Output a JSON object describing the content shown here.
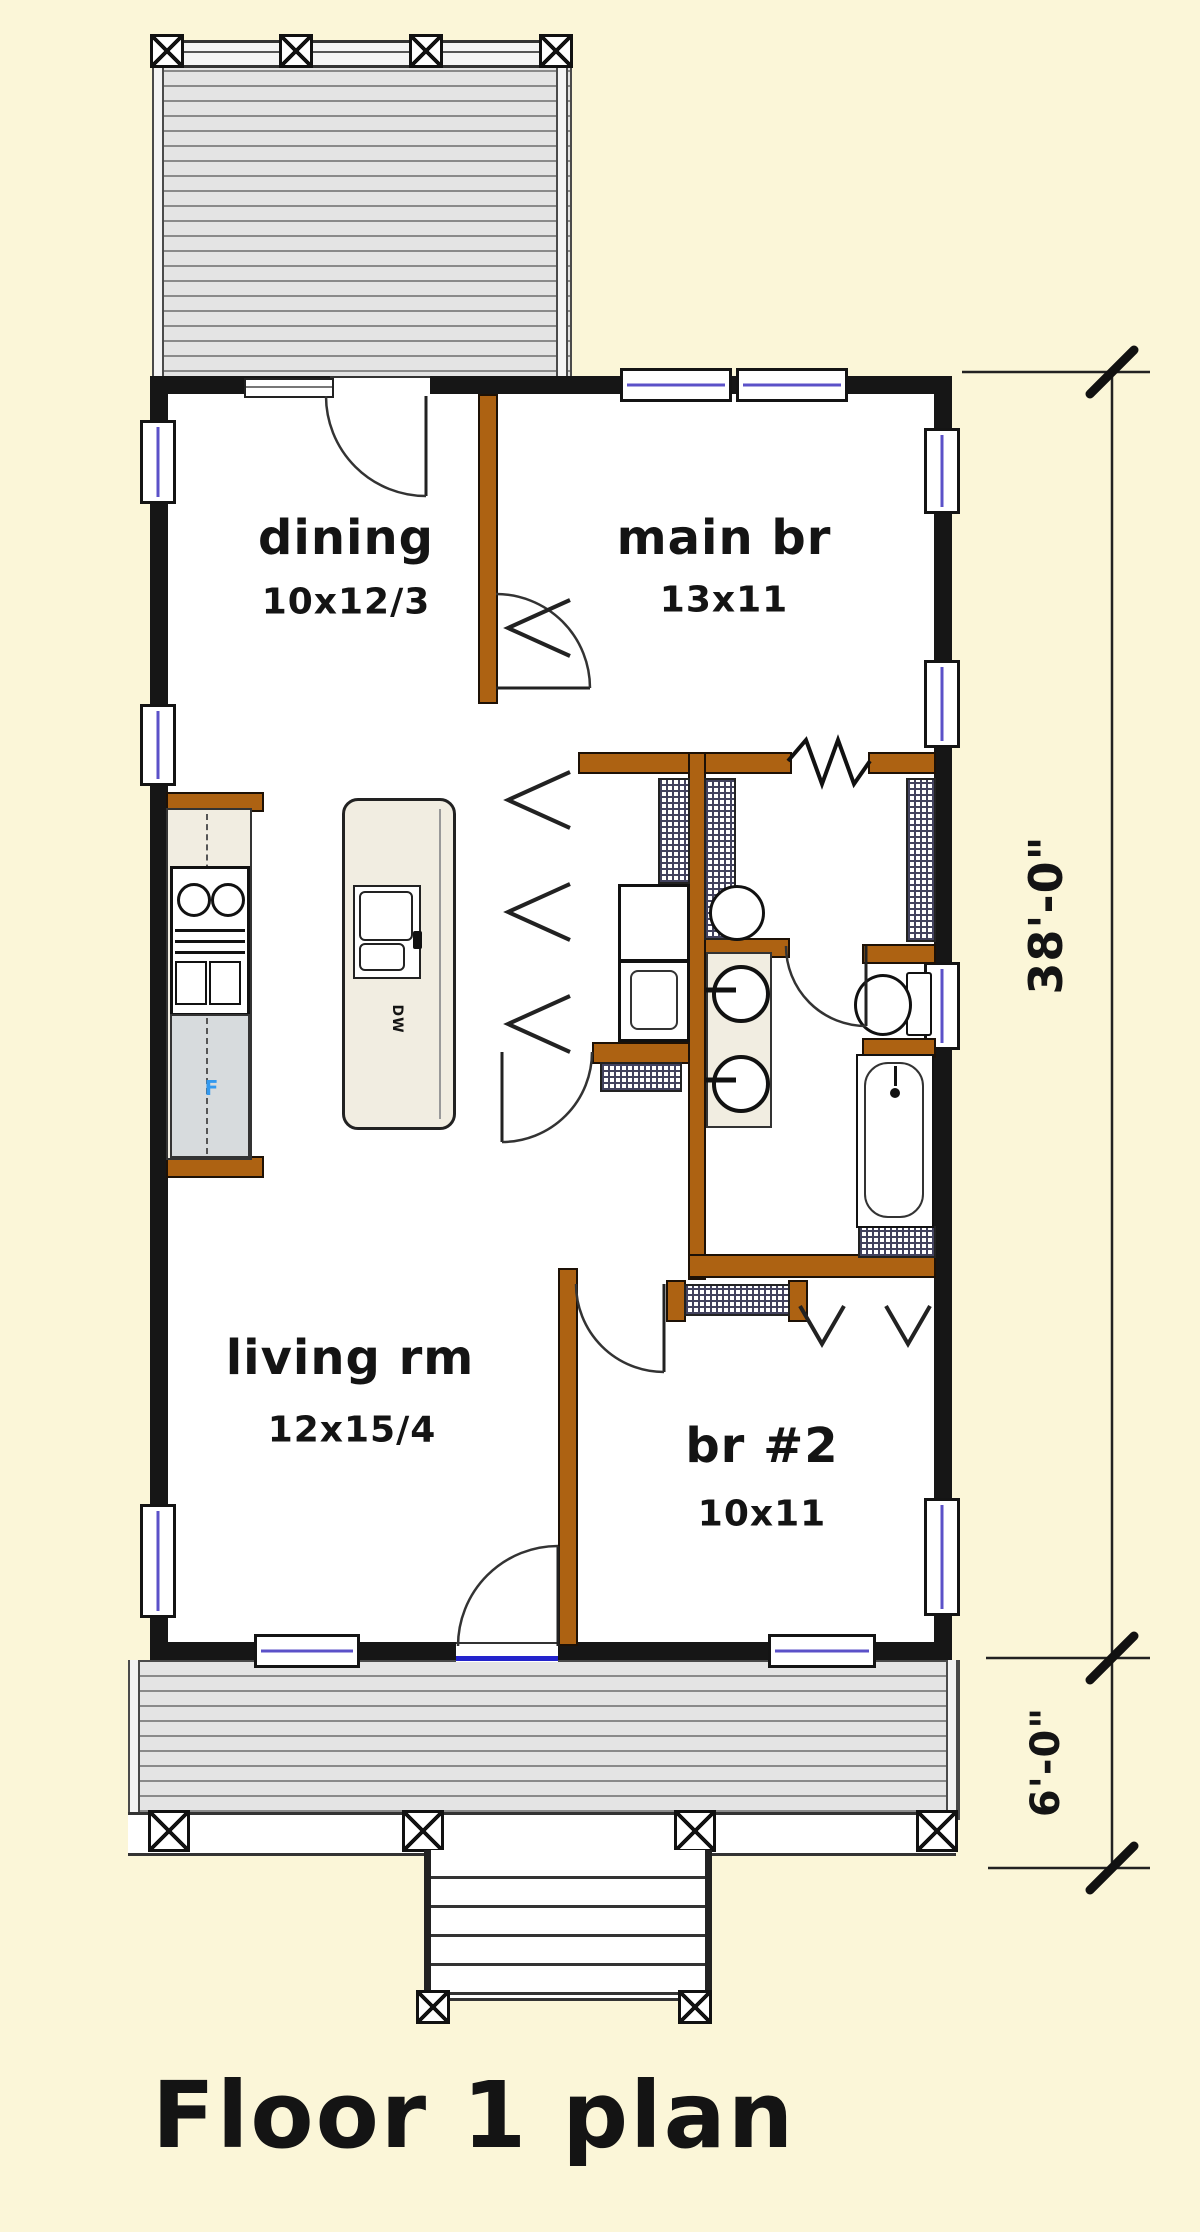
{
  "plan_title": "Floor 1 plan",
  "rooms": {
    "dining": {
      "label": "dining",
      "size": "10x12/3"
    },
    "main_bedroom": {
      "label": "main br",
      "size": "13x11"
    },
    "living_room": {
      "label": "living rm",
      "size": "12x15/4"
    },
    "bedroom_2": {
      "label": "br #2",
      "size": "10x11"
    }
  },
  "appliances": {
    "dishwasher_label": "DW",
    "fridge_label": "F"
  },
  "dimensions": {
    "house_depth": "38'-0\"",
    "porch_depth": "6'-0\""
  },
  "colors": {
    "background": "#FBF6D8",
    "exterior_wall": "#161616",
    "interior_wall_brown": "#AD6212",
    "window_accent": "#5B51C8",
    "deck_fill": "#E4E4E4",
    "threshold_blue": "#2323CC",
    "fridge_label_blue": "#3399EE",
    "counter_beige": "#F1EDE1"
  }
}
